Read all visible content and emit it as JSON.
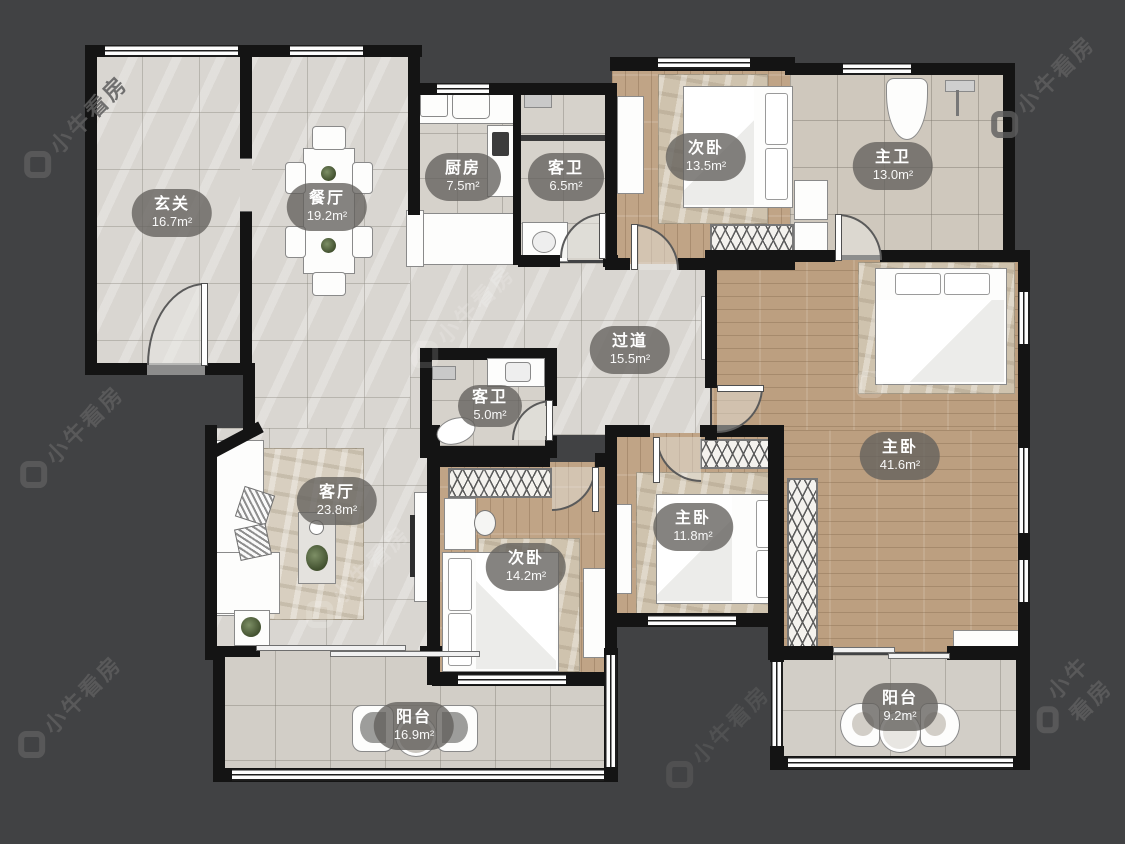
{
  "app": {
    "type_label": "floor-plan",
    "watermark_text": "小牛看房"
  },
  "rooms": [
    {
      "id": "entry",
      "name": "玄关",
      "area": "16.7m²"
    },
    {
      "id": "dining",
      "name": "餐厅",
      "area": "19.2m²"
    },
    {
      "id": "kitchen",
      "name": "厨房",
      "area": "7.5m²"
    },
    {
      "id": "bath-guest-upper",
      "name": "客卫",
      "area": "6.5m²"
    },
    {
      "id": "bedroom-upper",
      "name": "次卧",
      "area": "13.5m²"
    },
    {
      "id": "bath-master",
      "name": "主卫",
      "area": "13.0m²"
    },
    {
      "id": "hallway",
      "name": "过道",
      "area": "15.5m²"
    },
    {
      "id": "bath-guest-lower",
      "name": "客卫",
      "area": "5.0m²"
    },
    {
      "id": "living",
      "name": "客厅",
      "area": "23.8m²"
    },
    {
      "id": "bedroom-lower",
      "name": "次卧",
      "area": "14.2m²"
    },
    {
      "id": "bedroom-master-small",
      "name": "主卧",
      "area": "11.8m²"
    },
    {
      "id": "bedroom-master-large",
      "name": "主卧",
      "area": "41.6m²"
    },
    {
      "id": "balcony-left",
      "name": "阳台",
      "area": "16.9m²"
    },
    {
      "id": "balcony-right",
      "name": "阳台",
      "area": "9.2m²"
    }
  ],
  "colors": {
    "background": "#414244",
    "wall": "#141414",
    "tile_floor": "#d9d6d1",
    "wood_floor": "#c0a486",
    "label_pill": "rgba(99,96,92,0.78)"
  }
}
